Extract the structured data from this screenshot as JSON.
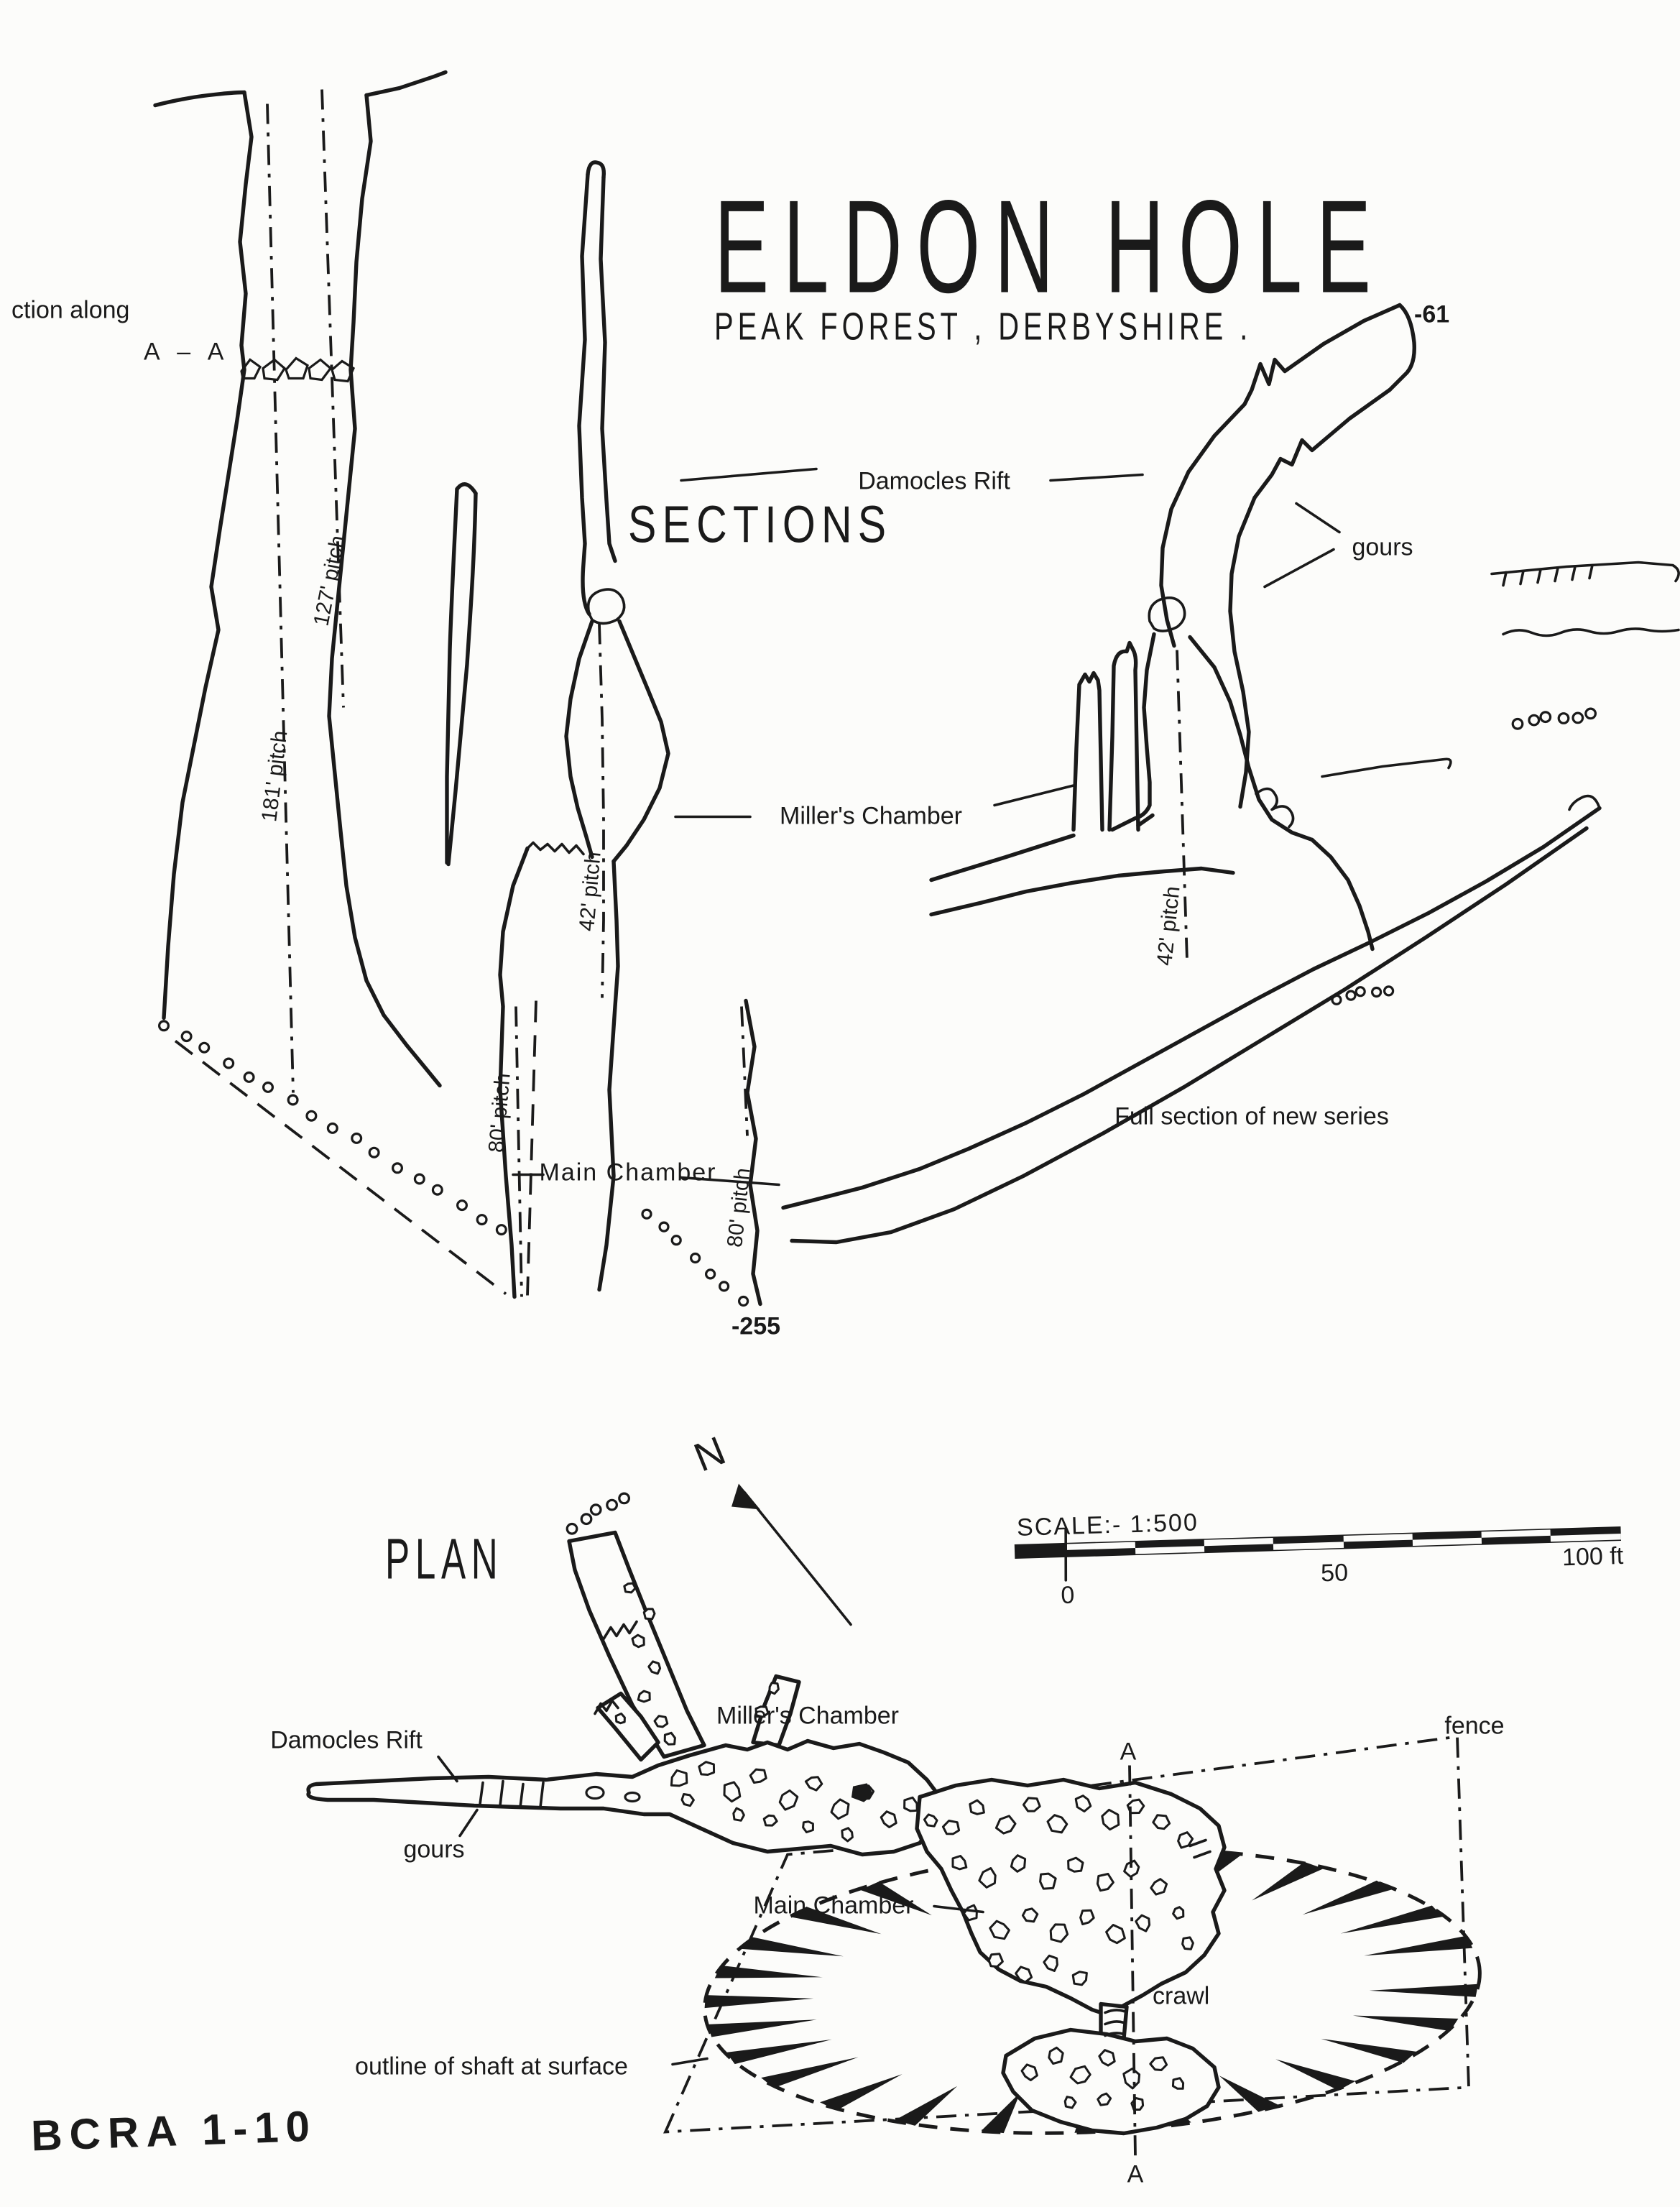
{
  "title": "ELDON HOLE",
  "subtitle": "PEAK FOREST , DERBYSHIRE .",
  "sections": {
    "heading": "SECTIONS",
    "section_along": "ction along",
    "section_aa": "A – A",
    "damocles_rift": "Damocles Rift",
    "gours": "gours",
    "depth_top": "-61",
    "pitch_127": "127' pitch",
    "pitch_181": "181' pitch",
    "pitch_42_mid": "42' pitch",
    "pitch_42_right": "42' pitch",
    "pitch_80_left": "80' pitch",
    "pitch_80_right": "80' pitch",
    "millers_chamber": "Miller's Chamber",
    "main_chamber": "Main Chamber",
    "full_section": "Full section of new series",
    "depth_bottom": "-255"
  },
  "plan": {
    "heading": "PLAN",
    "north": "N",
    "damocles_rift": "Damocles Rift",
    "gours": "gours",
    "millers_chamber": "Miller's Chamber",
    "main_chamber": "Main Chamber",
    "fence": "fence",
    "crawl": "crawl",
    "section_a_top": "A",
    "section_a_bottom": "A",
    "shaft_outline": "outline of shaft at surface"
  },
  "scalebar": {
    "label": "SCALE:- 1:500",
    "tick_0": "0",
    "tick_50": "50",
    "tick_100": "100 ft"
  },
  "footer": {
    "credit": "BCRA 1-10"
  },
  "colors": {
    "ink": "#1a1a1a",
    "paper": "#fcfcfa"
  }
}
